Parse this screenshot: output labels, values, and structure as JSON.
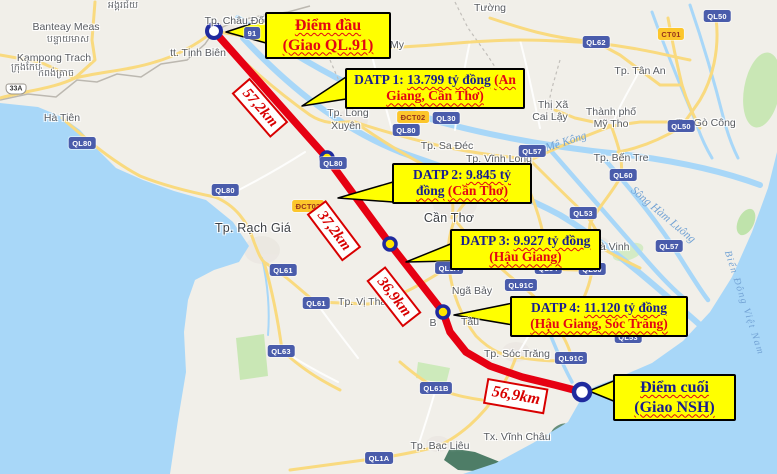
{
  "colors": {
    "route_red": "#e60012",
    "callout_bg": "#ffff00",
    "callout_navy": "#181d8f",
    "callout_red": "#e30613",
    "distance_red": "#d80000",
    "water": "#a8d7f8",
    "land": "#f1efe9",
    "road_yellow": "#f9da7f",
    "badge_blue": "#4a5cab",
    "badge_yellow": "#fcc62b"
  },
  "callouts": {
    "start": {
      "line1": "Điểm đầu",
      "line2": "(Giao QL.91)"
    },
    "end": {
      "line1": "Điểm cuối",
      "line2": "(Giao NSH)"
    },
    "datp1": {
      "prefix": "DATP 1:",
      "value": "13.799 tỷ đồng",
      "region": "(An Giang, Cần Thơ)"
    },
    "datp2": {
      "prefix": "DATP 2:",
      "value": "9.845 tỷ đồng",
      "region": "(Cần Thơ)"
    },
    "datp3": {
      "prefix": "DATP 3:",
      "value": "9.927 tỷ đồng",
      "region": "(Hậu Giang)"
    },
    "datp4": {
      "prefix": "DATP 4:",
      "value": "11.120 tỷ đồng",
      "region": "(Hậu Giang, Sóc Trăng)"
    }
  },
  "route": {
    "distance_labels": [
      {
        "text": "57,2km",
        "x": 260,
        "y": 108,
        "angle": 49
      },
      {
        "text": "37,2km",
        "x": 334,
        "y": 231,
        "angle": 53
      },
      {
        "text": "36,9km",
        "x": 394,
        "y": 297,
        "angle": 52
      },
      {
        "text": "56,9km",
        "x": 516,
        "y": 396,
        "angle": 10,
        "f": 16
      }
    ]
  },
  "map": {
    "place_labels": [
      {
        "t": "tt. Tịnh Biên",
        "x": 198,
        "y": 53
      },
      {
        "t": "Tp. Châu Đốc",
        "x": 237,
        "y": 21
      },
      {
        "t": "Tp. Long",
        "x": 348,
        "y": 113
      },
      {
        "t": "Xuyên",
        "x": 346,
        "y": 126
      },
      {
        "t": "Tp. Rạch Giá",
        "x": 253,
        "y": 228,
        "cls": "plc"
      },
      {
        "t": "Cần Thơ",
        "x": 449,
        "y": 218,
        "cls": "plc"
      },
      {
        "t": "Tp. Sa Đéc",
        "x": 447,
        "y": 146
      },
      {
        "t": "Tp. Vĩnh Long",
        "x": 499,
        "y": 159
      },
      {
        "t": "Tp. Vị Thanh",
        "x": 368,
        "y": 302
      },
      {
        "t": "Ngã Bảy",
        "x": 472,
        "y": 291
      },
      {
        "t": "B",
        "x": 433,
        "y": 323
      },
      {
        "t": "Tàu",
        "x": 470,
        "y": 322
      },
      {
        "t": "Tp. Sóc Trăng",
        "x": 517,
        "y": 354
      },
      {
        "t": "Tp. Bạc Liêu",
        "x": 440,
        "y": 446
      },
      {
        "t": "Tx. Vĩnh Châu",
        "x": 517,
        "y": 437
      },
      {
        "t": "Tp. Tân An",
        "x": 640,
        "y": 71
      },
      {
        "t": "Thị Xã",
        "x": 553,
        "y": 105
      },
      {
        "t": "Cai Lậy",
        "x": 550,
        "y": 117
      },
      {
        "t": "Thành phố",
        "x": 611,
        "y": 112
      },
      {
        "t": "Mỹ Tho",
        "x": 611,
        "y": 124
      },
      {
        "t": "Tx. Gò Công",
        "x": 706,
        "y": 123
      },
      {
        "t": "Tp. Bến Tre",
        "x": 621,
        "y": 158
      },
      {
        "t": "Tp. Trà Vinh",
        "x": 601,
        "y": 247
      },
      {
        "t": "Tường",
        "x": 490,
        "y": 8
      },
      {
        "t": "My",
        "x": 397,
        "y": 45
      },
      {
        "t": "Hà Tiên",
        "x": 62,
        "y": 118
      },
      {
        "t": "Banteay Meas",
        "x": 66,
        "y": 27
      },
      {
        "t": "បន្ទាយមាស",
        "x": 68,
        "y": 40,
        "cls": "plk"
      },
      {
        "t": "Kampong Trach",
        "x": 54,
        "y": 58
      },
      {
        "t": "កំពង់ត្រាច",
        "x": 56,
        "y": 74,
        "cls": "plk"
      },
      {
        "t": "ក្រុងកែប",
        "x": 26,
        "y": 68,
        "cls": "plk"
      },
      {
        "t": "អង្គរជ័យ",
        "x": 123,
        "y": 6,
        "cls": "plk"
      }
    ],
    "water_labels": [
      {
        "t": "Mê Kông",
        "x": 566,
        "y": 142,
        "rot": -18
      },
      {
        "t": "Sông Hàm Luông",
        "x": 663,
        "y": 215,
        "rot": 40
      },
      {
        "t": "Biển Đông Việt Nam",
        "x": 744,
        "y": 303,
        "rot": 72,
        "ls": 1.5,
        "f": 10
      }
    ],
    "road_badges": [
      {
        "t": "QL80",
        "x": 82,
        "y": 143
      },
      {
        "t": "QL80",
        "x": 225,
        "y": 190
      },
      {
        "t": "QL80",
        "x": 333,
        "y": 163
      },
      {
        "t": "QL80",
        "x": 406,
        "y": 130
      },
      {
        "t": "QL30",
        "x": 446,
        "y": 118
      },
      {
        "t": "ĐCT02",
        "x": 413,
        "y": 117,
        "k": "y"
      },
      {
        "t": "ĐCT02",
        "x": 308,
        "y": 206,
        "k": "y"
      },
      {
        "t": "CT01",
        "x": 671,
        "y": 34,
        "k": "y"
      },
      {
        "t": "QL62",
        "x": 596,
        "y": 42
      },
      {
        "t": "QL50",
        "x": 717,
        "y": 16
      },
      {
        "t": "QL50",
        "x": 681,
        "y": 126
      },
      {
        "t": "QL57",
        "x": 532,
        "y": 151
      },
      {
        "t": "QL57",
        "x": 669,
        "y": 246
      },
      {
        "t": "QL53",
        "x": 583,
        "y": 213
      },
      {
        "t": "QL53",
        "x": 628,
        "y": 337
      },
      {
        "t": "QL54",
        "x": 548,
        "y": 268
      },
      {
        "t": "QL60",
        "x": 623,
        "y": 175
      },
      {
        "t": "QL60",
        "x": 592,
        "y": 269
      },
      {
        "t": "QL61",
        "x": 283,
        "y": 270
      },
      {
        "t": "QL61",
        "x": 316,
        "y": 303
      },
      {
        "t": "QL63",
        "x": 281,
        "y": 351
      },
      {
        "t": "QL61B",
        "x": 436,
        "y": 388
      },
      {
        "t": "QL1A",
        "x": 449,
        "y": 268
      },
      {
        "t": "QL1A",
        "x": 379,
        "y": 458
      },
      {
        "t": "QL91C",
        "x": 521,
        "y": 285
      },
      {
        "t": "QL91C",
        "x": 571,
        "y": 358
      },
      {
        "t": "91",
        "x": 252,
        "y": 33
      }
    ],
    "shields": [
      {
        "t": "33A",
        "x": 16,
        "y": 89
      }
    ]
  }
}
